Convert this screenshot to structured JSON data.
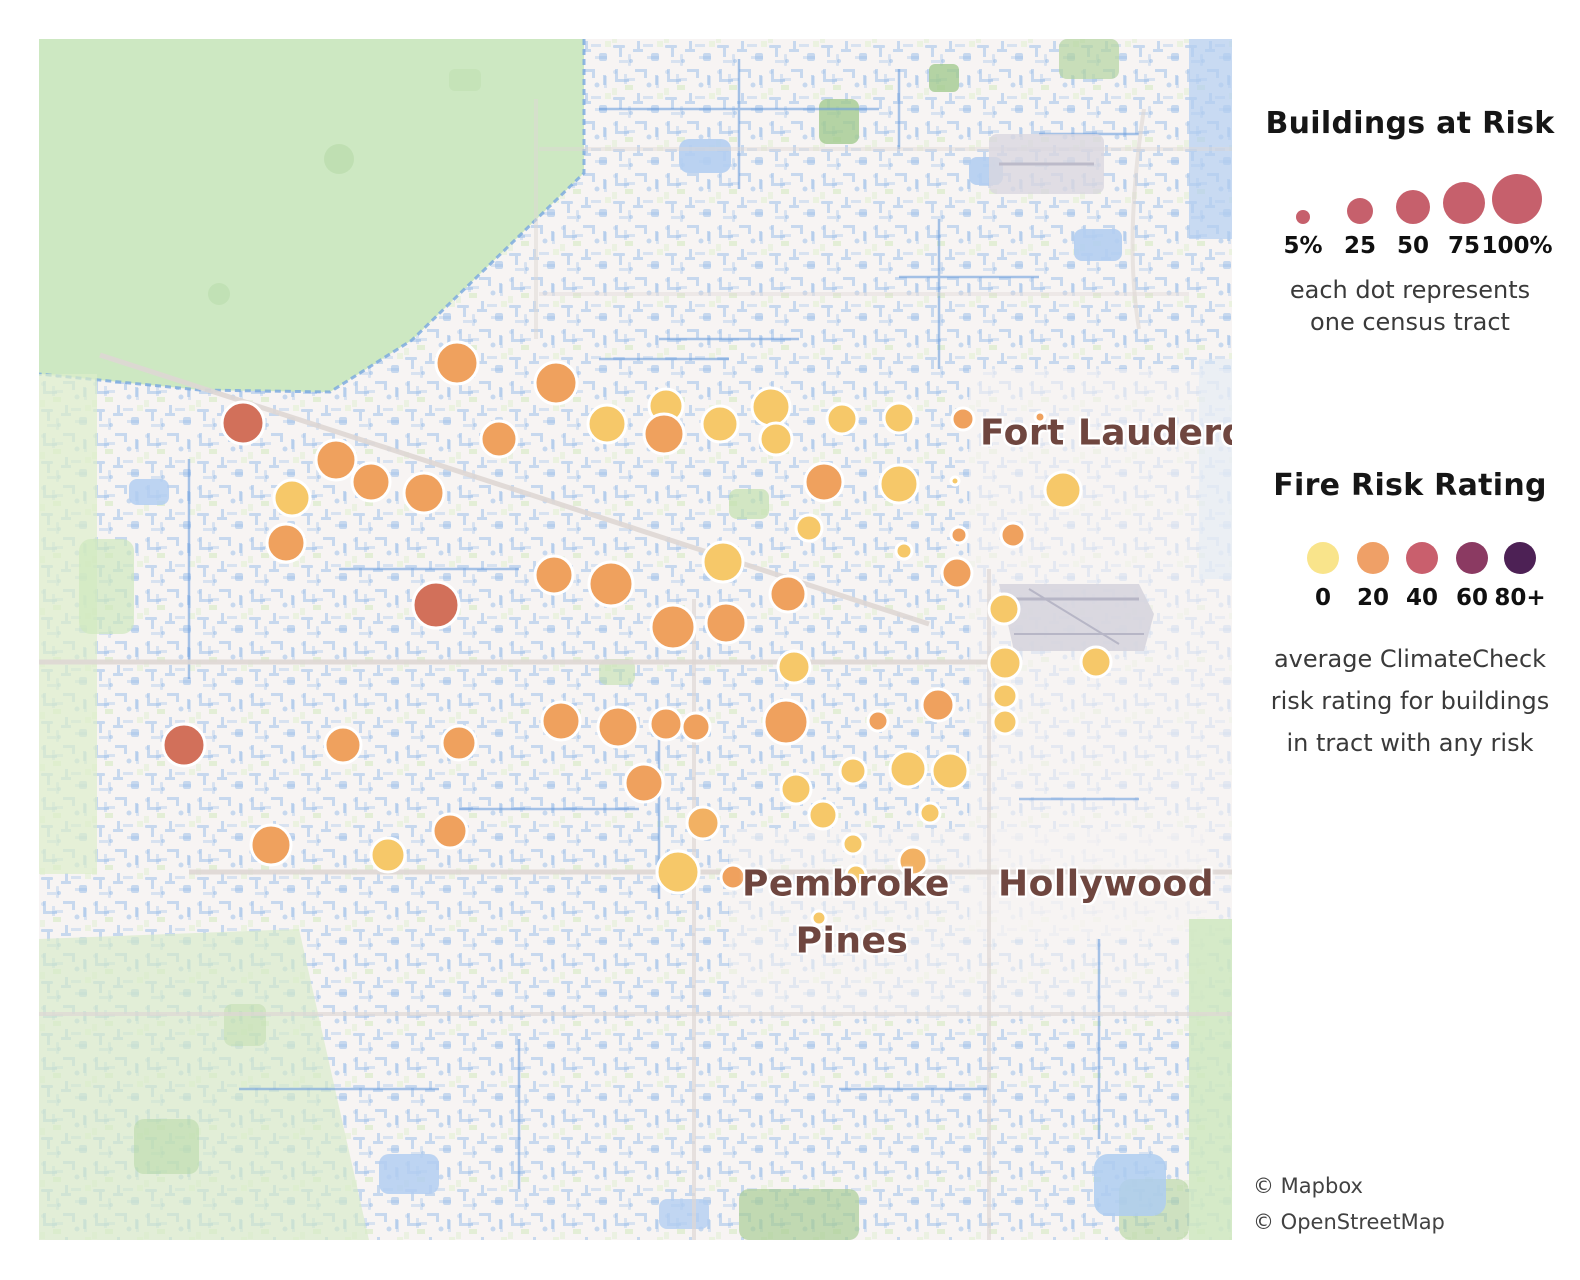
{
  "legend_buildings": {
    "title": "Buildings at Risk",
    "dot_color": "#c6606c",
    "sizes": [
      {
        "label": "5%",
        "r": 7
      },
      {
        "label": "25",
        "r": 13
      },
      {
        "label": "50",
        "r": 17
      },
      {
        "label": "75",
        "r": 21
      },
      {
        "label": "100%",
        "r": 25
      }
    ],
    "caption_line1": "each dot represents",
    "caption_line2": "one census tract"
  },
  "legend_fire": {
    "title": "Fire Risk Rating",
    "stops": [
      {
        "label": "0",
        "color": "#f9e48b"
      },
      {
        "label": "20",
        "color": "#efa067"
      },
      {
        "label": "40",
        "color": "#c95f6d"
      },
      {
        "label": "60",
        "color": "#8b3a62"
      },
      {
        "label": "80+",
        "color": "#4d2155"
      }
    ],
    "caption_line1": "average ClimateCheck",
    "caption_line2": "risk rating for buildings",
    "caption_line3": "in tract with any risk"
  },
  "map": {
    "labels": [
      {
        "text": "Fort Lauderd",
        "x": 941,
        "y": 394,
        "align": "left"
      },
      {
        "text": "Pembroke",
        "x": 807,
        "y": 845,
        "align": "center"
      },
      {
        "text": "Pines",
        "x": 813,
        "y": 902,
        "align": "center"
      },
      {
        "text": "Hollywood",
        "x": 1067,
        "y": 845,
        "align": "center"
      }
    ],
    "attribution": [
      "© Mapbox",
      "© OpenStreetMap"
    ]
  },
  "chart_data": {
    "type": "bubble_map",
    "title": "Buildings at Risk / Fire Risk Rating by census tract",
    "size_encoding": "dot radius = percent of buildings at risk (5% to 100%)",
    "color_encoding": "dot color = average ClimateCheck fire risk rating (0 to 80+)",
    "palette": {
      "y": "#f6c869",
      "yo": "#f2b163",
      "o": "#efa15e",
      "r": "#d2705a"
    },
    "dots": [
      [
        204,
        384,
        21,
        "r"
      ],
      [
        418,
        324,
        21,
        "o"
      ],
      [
        517,
        344,
        21,
        "o"
      ],
      [
        297,
        421,
        20,
        "o"
      ],
      [
        332,
        443,
        19,
        "o"
      ],
      [
        385,
        454,
        20,
        "o"
      ],
      [
        253,
        459,
        18,
        "y"
      ],
      [
        247,
        504,
        19,
        "o"
      ],
      [
        460,
        400,
        18,
        "o"
      ],
      [
        568,
        385,
        19,
        "y"
      ],
      [
        627,
        367,
        17,
        "y"
      ],
      [
        625,
        395,
        20,
        "o"
      ],
      [
        681,
        385,
        18,
        "y"
      ],
      [
        732,
        368,
        19,
        "y"
      ],
      [
        737,
        400,
        16,
        "y"
      ],
      [
        803,
        380,
        15,
        "y"
      ],
      [
        860,
        379,
        15,
        "y"
      ],
      [
        924,
        380,
        11,
        "o"
      ],
      [
        1001,
        378,
        5,
        "o"
      ],
      [
        785,
        443,
        19,
        "o"
      ],
      [
        860,
        445,
        19,
        "y"
      ],
      [
        916,
        442,
        4,
        "y"
      ],
      [
        1024,
        451,
        18,
        "y"
      ],
      [
        770,
        489,
        13,
        "y"
      ],
      [
        684,
        523,
        20,
        "y"
      ],
      [
        865,
        512,
        8,
        "y"
      ],
      [
        920,
        496,
        8,
        "o"
      ],
      [
        974,
        496,
        12,
        "o"
      ],
      [
        918,
        534,
        15,
        "o"
      ],
      [
        397,
        566,
        23,
        "r"
      ],
      [
        515,
        536,
        19,
        "o"
      ],
      [
        572,
        545,
        22,
        "o"
      ],
      [
        749,
        555,
        18,
        "o"
      ],
      [
        687,
        584,
        20,
        "o"
      ],
      [
        634,
        588,
        22,
        "o"
      ],
      [
        965,
        570,
        15,
        "y"
      ],
      [
        966,
        624,
        16,
        "y"
      ],
      [
        966,
        657,
        12,
        "y"
      ],
      [
        966,
        683,
        12,
        "y"
      ],
      [
        1057,
        623,
        15,
        "y"
      ],
      [
        755,
        628,
        16,
        "y"
      ],
      [
        145,
        706,
        21,
        "r"
      ],
      [
        304,
        706,
        18,
        "o"
      ],
      [
        420,
        704,
        17,
        "o"
      ],
      [
        522,
        682,
        19,
        "o"
      ],
      [
        579,
        688,
        20,
        "o"
      ],
      [
        627,
        685,
        16,
        "o"
      ],
      [
        657,
        688,
        14,
        "o"
      ],
      [
        747,
        683,
        22,
        "o"
      ],
      [
        839,
        682,
        10,
        "o"
      ],
      [
        899,
        666,
        16,
        "o"
      ],
      [
        605,
        744,
        19,
        "o"
      ],
      [
        757,
        750,
        15,
        "y"
      ],
      [
        814,
        732,
        13,
        "y"
      ],
      [
        869,
        730,
        18,
        "y"
      ],
      [
        911,
        732,
        18,
        "y"
      ],
      [
        784,
        776,
        14,
        "y"
      ],
      [
        891,
        774,
        10,
        "y"
      ],
      [
        814,
        805,
        10,
        "y"
      ],
      [
        874,
        822,
        14,
        "yo"
      ],
      [
        817,
        836,
        10,
        "y"
      ],
      [
        780,
        879,
        7,
        "y"
      ],
      [
        232,
        806,
        20,
        "o"
      ],
      [
        349,
        816,
        17,
        "y"
      ],
      [
        411,
        792,
        17,
        "o"
      ],
      [
        664,
        784,
        16,
        "yo"
      ],
      [
        639,
        833,
        21,
        "y"
      ],
      [
        694,
        838,
        12,
        "o"
      ]
    ]
  }
}
